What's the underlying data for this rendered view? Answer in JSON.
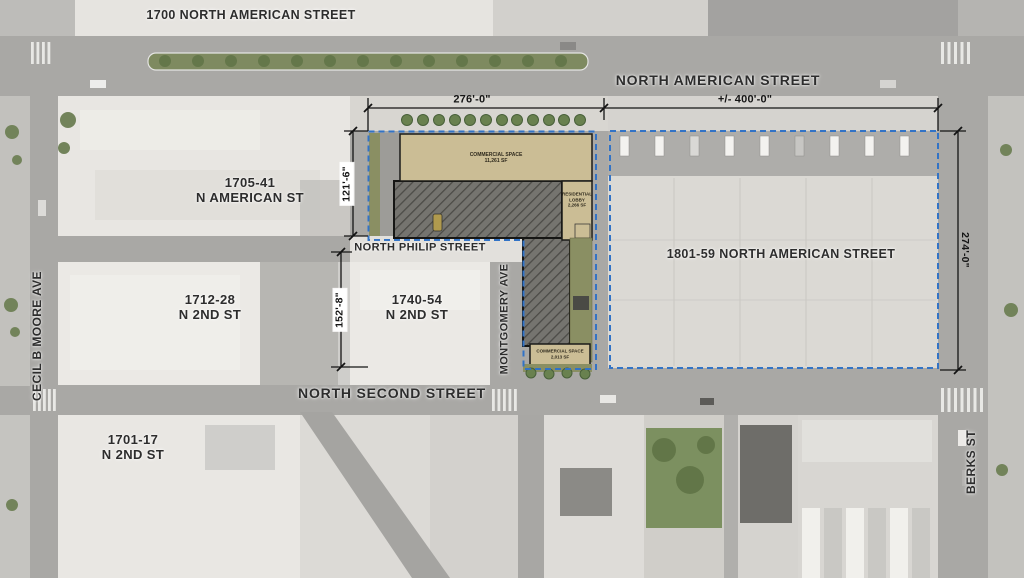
{
  "colors": {
    "street": "#a9a8a5",
    "block": "#e9e7e3",
    "tan": "#cbbd95",
    "hatch-bg": "#75746f",
    "hatch-line": "#4c4b47",
    "dash-blue": "#3273c6",
    "ink": "#2d2d2d",
    "dim-ink": "#151515",
    "green": "#76885c",
    "olive": "#8a8f63"
  },
  "streets": {
    "north_american": "NORTH AMERICAN STREET",
    "north_philip": "NORTH PHILIP STREET",
    "north_second": "NORTH SECOND STREET",
    "cecil_b_moore": "CECIL B MOORE AVE",
    "montgomery": "MONTGOMERY AVE",
    "berks": "BERKS ST"
  },
  "parcels": {
    "p1700": "1700 NORTH AMERICAN STREET",
    "p1705_line1": "1705-41",
    "p1705_line2": "N AMERICAN ST",
    "p1801": "1801-59 NORTH AMERICAN STREET",
    "p1712_line1": "1712-28",
    "p1712_line2": "N 2ND ST",
    "p1740_line1": "1740-54",
    "p1740_line2": "N 2ND ST",
    "p1701_line1": "1701-17",
    "p1701_line2": "N 2ND ST"
  },
  "dimensions": {
    "site_width": "276'-0\"",
    "parcel_width": "+/- 400'-0\"",
    "site_depth_north": "121'-6\"",
    "site_depth_south": "152'-8\"",
    "parcel_depth_east": "274'-0\""
  },
  "plan": {
    "commercial_north_name": "COMMERCIAL SPACE",
    "commercial_north_area": "11,261 SF",
    "lobby_line1": "RESIDENTIAL",
    "lobby_line2": "LOBBY",
    "lobby_area": "2,266 SF",
    "commercial_south_name": "COMMERCIAL SPACE",
    "commercial_south_area": "2,013 SF"
  }
}
